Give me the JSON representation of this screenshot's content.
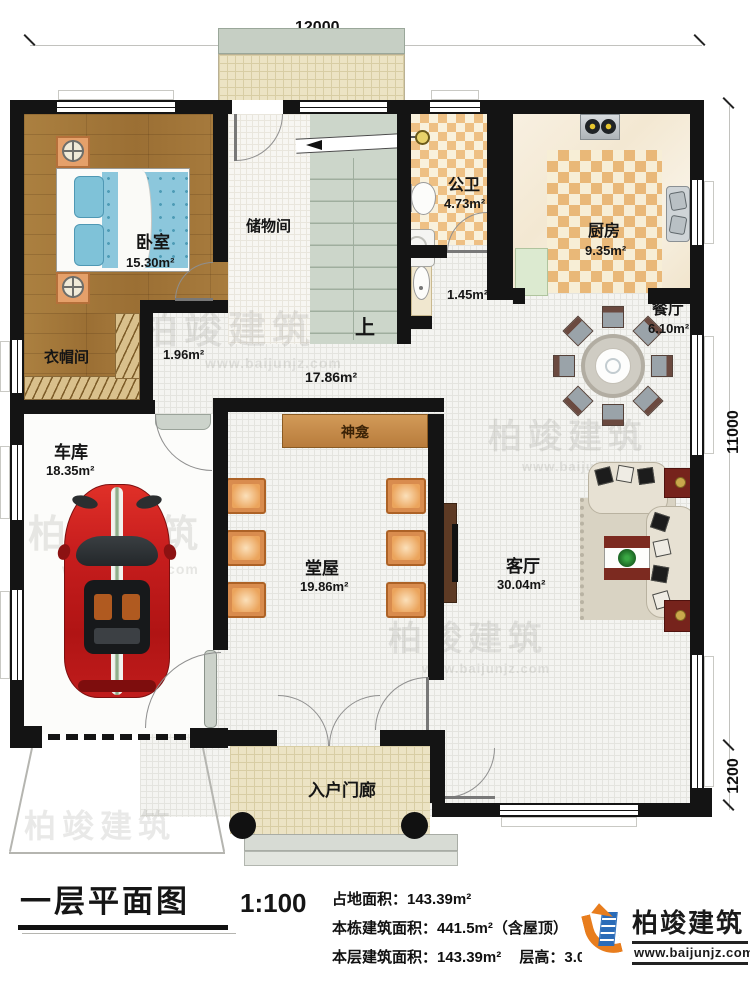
{
  "dims": {
    "top": "12000",
    "right_upper": "11000",
    "right_lower": "1200"
  },
  "rooms": {
    "bedroom": {
      "name": "卧室",
      "area": "15.30m²"
    },
    "storage": {
      "name": "储物间"
    },
    "bath": {
      "name": "公卫",
      "area": "4.73m²"
    },
    "kitchen": {
      "name": "厨房",
      "area": "9.35m²"
    },
    "dining": {
      "name": "餐厅",
      "area": "6.10m²"
    },
    "cloak": {
      "name": "衣帽间"
    },
    "passage": {
      "area": "1.96m²"
    },
    "hallway": {
      "area": "17.86m²"
    },
    "wash": {
      "area": "1.45m²"
    },
    "garage": {
      "name": "车库",
      "area": "18.35m²"
    },
    "hall": {
      "name": "堂屋",
      "area": "19.86m²"
    },
    "living": {
      "name": "客厅",
      "area": "30.04m²"
    },
    "porch": {
      "name": "入户门廊"
    },
    "shrine": {
      "name": "神龛"
    },
    "stairs": {
      "label": "上"
    }
  },
  "title_block": {
    "title": "一层平面图",
    "scale": "1:100",
    "stat1": "占地面积：143.39m²",
    "stat2": "本栋建筑面积：441.5m²（含屋顶）",
    "stat3": "本层建筑面积：143.39m²",
    "stat4": "层高：3.0m"
  },
  "watermark": {
    "brand": "柏竣建筑",
    "url": "www.baijunjz.com"
  },
  "logo": {
    "brand": "柏竣建筑",
    "url": "www.baijunjz.com"
  },
  "colors": {
    "wall": "#141414",
    "wood_floor": "#a87c3e",
    "bed_blue": "#8cc7dc",
    "car_red": "#c61f1f",
    "chair_orange": "#d98c4e",
    "shrine_tan": "#c08648",
    "stair_green": "#ccd6ca",
    "bath_checker": "#eec084",
    "porch_beige": "#ece3c4",
    "logo_orange": "#e87d1d",
    "logo_blue": "#2b6cb8"
  }
}
